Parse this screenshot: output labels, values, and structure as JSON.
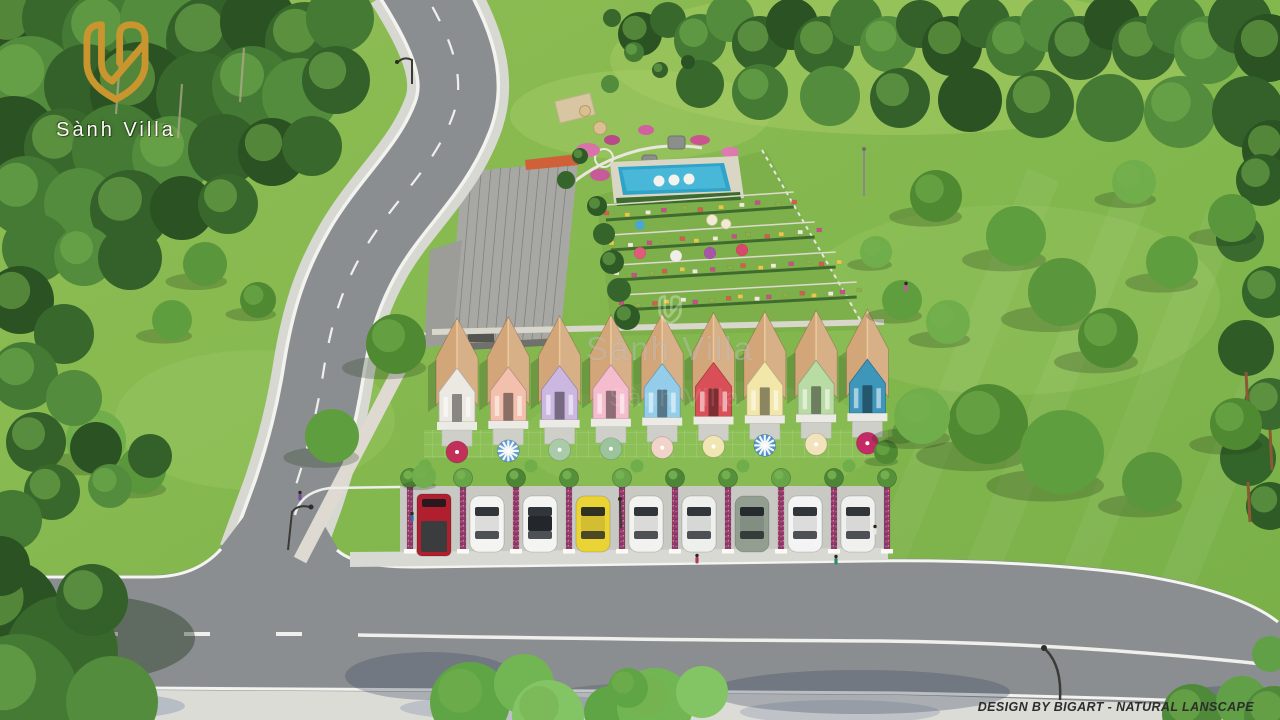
{
  "branding": {
    "name": "Sành Villa",
    "logo_color": "#c9952e",
    "text_color": "#fdfbf4"
  },
  "watermark": {
    "text": "Sành Villa"
  },
  "credit": {
    "text": "DESIGN BY BIGART - NATURAL LANSCAPE"
  },
  "scene": {
    "type": "aerial-3d-architectural-render",
    "palette": {
      "grass": "#83b84e",
      "grass_light": "#9cc45f",
      "forest": "#33602a",
      "road": "#8b8e91",
      "road_line": "#f2f2ee",
      "sidewalk": "#dcdcd7",
      "pool": "#2fa3c8",
      "roof_tan": "#d2a678",
      "building_roof": "#a7a7a3",
      "building_accent": "#d06038"
    },
    "houses": [
      {
        "gable": "#ece8e2"
      },
      {
        "gable": "#f2c0ac"
      },
      {
        "gable": "#cbb7e0"
      },
      {
        "gable": "#f4bccd"
      },
      {
        "gable": "#93cdea"
      },
      {
        "gable": "#d94f58"
      },
      {
        "gable": "#f2e6a8"
      },
      {
        "gable": "#b9dba4"
      },
      {
        "gable": "#3e96ba"
      }
    ],
    "umbrellas": [
      {
        "color": "#c23059",
        "striped": false
      },
      {
        "color": "#5f9fd4",
        "striped": true
      },
      {
        "color": "#a9cbaa",
        "striped": false
      },
      {
        "color": "#9cc49c",
        "striped": false
      },
      {
        "color": "#f1d3c9",
        "striped": false
      },
      {
        "color": "#f2e5b4",
        "striped": false
      },
      {
        "color": "#4f93cc",
        "striped": true
      },
      {
        "color": "#f2e3bd",
        "striped": false
      },
      {
        "color": "#c42a66",
        "striped": false
      }
    ],
    "cars": [
      {
        "type": "pickup",
        "color": "#b01f2e"
      },
      {
        "type": "sedan",
        "color": "#f4f4f2"
      },
      {
        "type": "sedan",
        "color": "#f4f4f2",
        "roof": "#23262a"
      },
      {
        "type": "sedan",
        "color": "#e9d335"
      },
      {
        "type": "sedan",
        "color": "#f2f2f0"
      },
      {
        "type": "sedan",
        "color": "#eef0ee"
      },
      {
        "type": "sedan",
        "color": "#929e90"
      },
      {
        "type": "sedan",
        "color": "#f4f4f4"
      },
      {
        "type": "sedan",
        "color": "#f0f0ee"
      }
    ],
    "pool": {
      "color": "#2fa3c8",
      "floats": 3
    },
    "flowerbed_colors": [
      "#d95a4e",
      "#e8c84a",
      "#f0ead8",
      "#c94f8a",
      "#8fae4a"
    ]
  }
}
